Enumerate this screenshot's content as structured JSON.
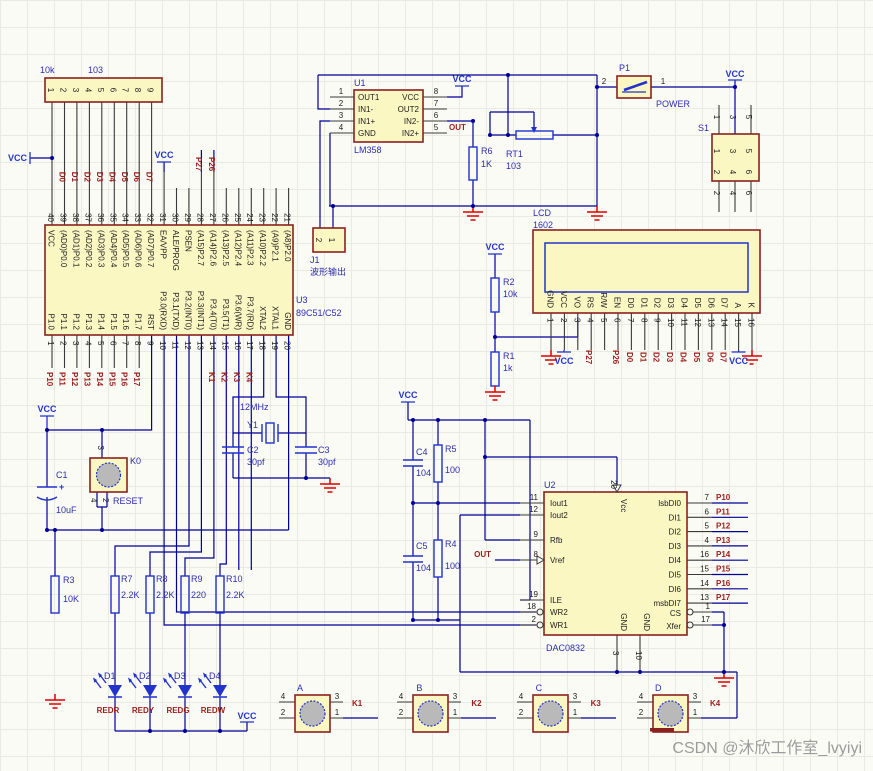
{
  "vcc": "VCC",
  "watermark": "CSDN @沐欣工作室_lvyiyi",
  "p27": "P27",
  "p26": "P26",
  "d_bus": [
    "D0",
    "D1",
    "D2",
    "D3",
    "D4",
    "D5",
    "D6",
    "D7"
  ],
  "p_bus": [
    "P10",
    "P11",
    "P12",
    "P13",
    "P14",
    "P15",
    "P16",
    "P17"
  ],
  "k_bus": [
    "K1",
    "K2",
    "K3",
    "K4"
  ],
  "rn1": {
    "value1": "10k",
    "value2": "103",
    "pins": [
      "1",
      "2",
      "3",
      "4",
      "5",
      "6",
      "7",
      "8",
      "9"
    ]
  },
  "mcu": {
    "ref": "U3",
    "part": "89C51/C52",
    "top_nums": [
      "40",
      "39",
      "38",
      "37",
      "36",
      "35",
      "34",
      "33",
      "32",
      "31",
      "30",
      "29",
      "28",
      "27",
      "26",
      "25",
      "24",
      "23",
      "22",
      "21"
    ],
    "top_labels": [
      "VCC",
      "(AD0)P0.0",
      "(AD1)P0.1",
      "(AD2)P0.2",
      "(AD3)P0.3",
      "(AD4)P0.4",
      "(AD5)P0.5",
      "(AD6)P0.6",
      "(AD7)P0.7",
      "EA/VPP",
      "ALE/PROG",
      "PSEN",
      "(A15)P2.7",
      "(A14)P2.6",
      "(A13)P2.5",
      "(A12)P2.4",
      "(A11)P2.3",
      "(A10)P2.2",
      "(A9)P2.1",
      "(A8)P2.0"
    ],
    "bot_nums": [
      "1",
      "2",
      "3",
      "4",
      "5",
      "6",
      "7",
      "8",
      "9",
      "10",
      "11",
      "12",
      "13",
      "14",
      "15",
      "16",
      "17",
      "18",
      "19",
      "20"
    ],
    "bot_labels": [
      "P1.0",
      "P1.1",
      "P1.2",
      "P1.3",
      "P1.4",
      "P1.5",
      "P1.6",
      "P1.7",
      "RST",
      "P3.0(RXD)",
      "P3.1(TXD)",
      "P3.2(INT0)",
      "P3.3(INT1)",
      "P3.4(T0)",
      "P3.5(T1)",
      "P3.6(WR)",
      "P3.7(RD)",
      "XTAL2",
      "XTAL1",
      "GND"
    ]
  },
  "u1": {
    "ref": "U1",
    "part": "LM358",
    "lnums": [
      "1",
      "2",
      "3",
      "4"
    ],
    "llabels": [
      "OUT1",
      "IN1-",
      "IN1+",
      "GND"
    ],
    "rnums": [
      "8",
      "7",
      "6",
      "5"
    ],
    "rlabels": [
      "VCC",
      "OUT2",
      "IN2-",
      "IN2+"
    ],
    "out": "OUT"
  },
  "j1": {
    "ref": "J1",
    "desc": "波形输出",
    "pins": [
      "2",
      "1"
    ]
  },
  "rt1": {
    "ref": "RT1",
    "value": "103"
  },
  "p1": {
    "ref": "P1",
    "label": "POWER",
    "pin_l": "2",
    "pin_r": "1"
  },
  "s1": {
    "ref": "S1",
    "row1": [
      "1",
      "3",
      "5"
    ],
    "row2": [
      "2",
      "4",
      "6"
    ]
  },
  "lcd": {
    "ref": "LCD",
    "part": "1602",
    "labels": [
      "GND",
      "VCC",
      "VO",
      "RS",
      "R/W",
      "EN",
      "D0",
      "D1",
      "D2",
      "D3",
      "D4",
      "D5",
      "D6",
      "D7",
      "A",
      "K"
    ],
    "nums": [
      "1",
      "2",
      "3",
      "4",
      "5",
      "6",
      "7",
      "8",
      "9",
      "10",
      "11",
      "12",
      "13",
      "14",
      "15",
      "16"
    ]
  },
  "r1": {
    "ref": "R1",
    "value": "1k"
  },
  "r2": {
    "ref": "R2",
    "value": "10k"
  },
  "r3": {
    "ref": "R3",
    "value": "10K"
  },
  "r4": {
    "ref": "R4",
    "value": "100"
  },
  "r5": {
    "ref": "R5",
    "value": "100"
  },
  "r6": {
    "ref": "R6",
    "value": "1K"
  },
  "r7": {
    "ref": "R7",
    "value": "2.2K"
  },
  "r8": {
    "ref": "R8",
    "value": "2.2K"
  },
  "r9": {
    "ref": "R9",
    "value": "220"
  },
  "r10": {
    "ref": "R10",
    "value": "2.2K"
  },
  "c1": {
    "ref": "C1",
    "value": "10uF",
    "plus": "+"
  },
  "c2": {
    "ref": "C2",
    "value": "30pf"
  },
  "c3": {
    "ref": "C3",
    "value": "30pf"
  },
  "c4": {
    "ref": "C4",
    "value": "104"
  },
  "c5": {
    "ref": "C5",
    "value": "104"
  },
  "y1": {
    "ref": "Y1",
    "freq": "12MHz"
  },
  "k0": {
    "ref": "K0",
    "net": "RESET",
    "pin_top": "3",
    "pin_bl": "4",
    "pin_br": "2"
  },
  "u2": {
    "ref": "U2",
    "part": "DAC0832",
    "vcc": "Vcc",
    "pin20": "20",
    "lnums": [
      "11",
      "12",
      "9",
      "8",
      "19",
      "18",
      "2"
    ],
    "llabels": [
      "Iout1",
      "Iout2",
      "Rfb",
      "Vref",
      "ILE",
      "WR2",
      "WR1"
    ],
    "rnums": [
      "7",
      "6",
      "5",
      "4",
      "16",
      "15",
      "14",
      "13"
    ],
    "rlabels": [
      "lsbDI0",
      "DI1",
      "DI2",
      "DI3",
      "DI4",
      "DI5",
      "DI6",
      "msbDI7"
    ],
    "cs": "CS",
    "cs_num": "1",
    "xfer": "Xfer",
    "xfer_num": "17",
    "gnd": "GND",
    "g1": "3",
    "g2": "10",
    "out": "OUT"
  },
  "leds": {
    "refs": [
      "D1",
      "D2",
      "D3",
      "D4"
    ],
    "nets": [
      "REDR",
      "REDY",
      "REDG",
      "REDW"
    ]
  },
  "buttons": {
    "names": [
      "A",
      "B",
      "C",
      "D"
    ],
    "p_tl": "4",
    "p_bl": "2",
    "p_tr": "3",
    "p_br": "1"
  }
}
